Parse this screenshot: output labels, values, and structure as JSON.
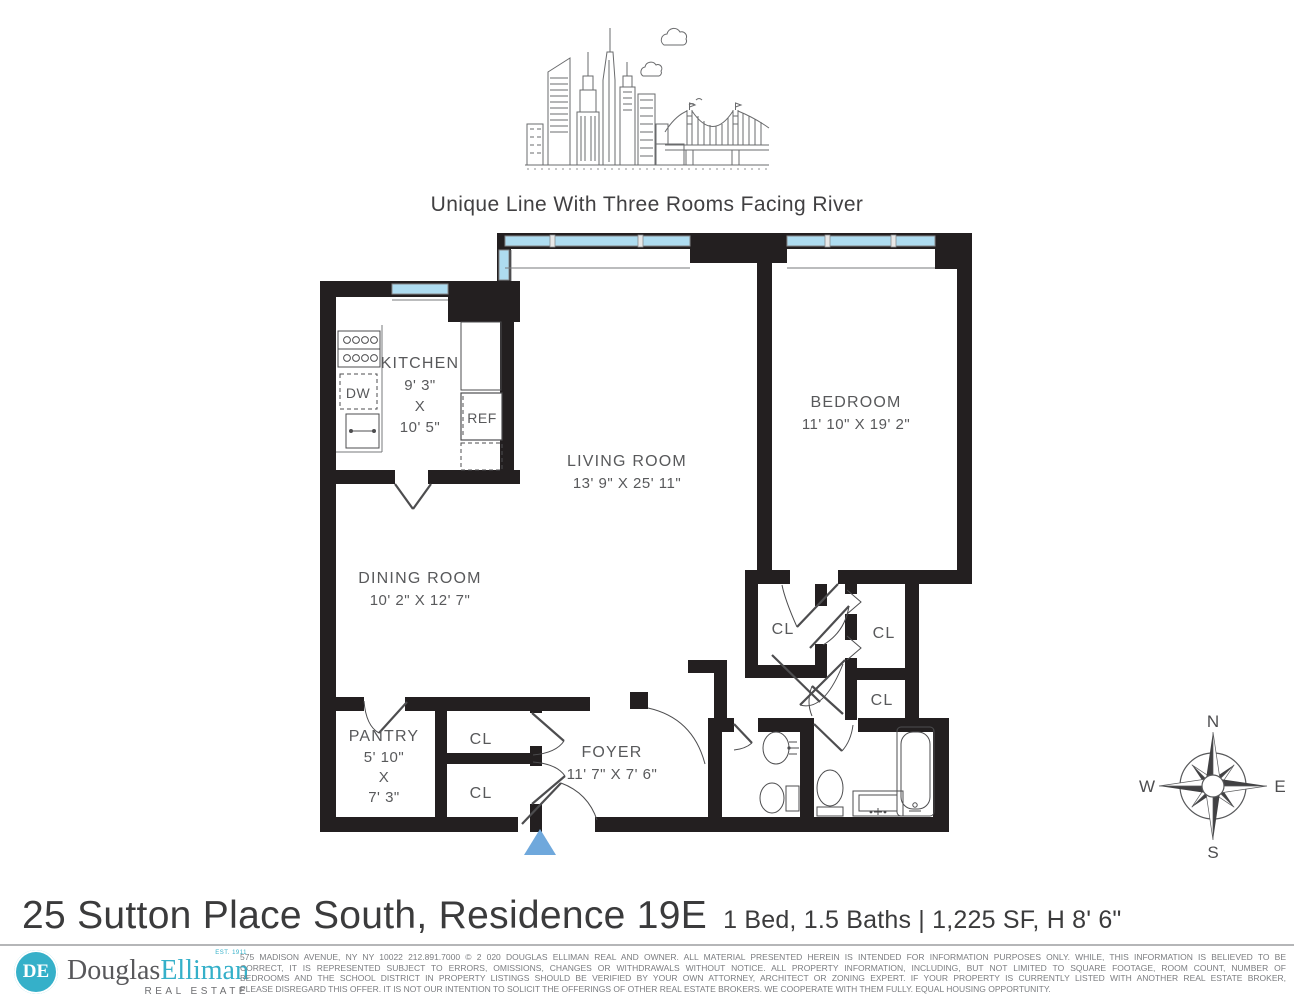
{
  "header": {
    "tagline": "Unique Line With Three Rooms Facing River"
  },
  "floorplan": {
    "rooms": {
      "kitchen": {
        "name": "KITCHEN",
        "dim1": "9' 3\"",
        "dim_x": "X",
        "dim2": "10' 5\""
      },
      "living": {
        "name": "LIVING ROOM",
        "dims": "13' 9\" X 25' 11\""
      },
      "bedroom": {
        "name": "BEDROOM",
        "dims": "11' 10\" X 19' 2\""
      },
      "dining": {
        "name": "DINING ROOM",
        "dims": "10' 2\" X 12' 7\""
      },
      "pantry": {
        "name": "PANTRY",
        "dim1": "5' 10\"",
        "dim_x": "X",
        "dim2": "7' 3\""
      },
      "foyer": {
        "name": "FOYER",
        "dims": "11' 7\" X 7' 6\""
      }
    },
    "fixtures": {
      "dishwasher": "DW",
      "refrigerator": "REF"
    },
    "closet_label": "CL",
    "compass": {
      "n": "N",
      "s": "S",
      "e": "E",
      "w": "W"
    }
  },
  "footer": {
    "address": "25 Sutton Place South, Residence 19E",
    "summary": "1 Bed, 1.5 Baths | 1,225 SF, H 8' 6\"",
    "brand": {
      "monogram": "DE",
      "name_part1": "Douglas",
      "name_part2": "Elliman",
      "est": "EST. 1911",
      "division": "REAL ESTATE"
    },
    "disclaimer_lines": [
      "575 MADISON AVENUE, NY NY 10022 212.891.7000 © 2 020 DOUGLAS ELLIMAN REAL AND OWNER. ALL MATERIAL PRESENTED HEREIN IS INTENDED FOR INFORMATION PURPOSES ONLY. WHILE, THIS INFORMATION IS BELIEVED TO BE",
      "CORRECT, IT IS REPRESENTED SUBJECT TO ERRORS, OMISSIONS, CHANGES OR WITHDRAWALS WITHOUT NOTICE. ALL PROPERTY INFORMATION, INCLUDING, BUT NOT LIMITED TO SQUARE FOOTAGE, ROOM COUNT, NUMBER OF",
      "BEDROOMS AND THE SCHOOL DISTRICT IN PROPERTY LISTINGS SHOULD BE VERIFIED BY YOUR OWN ATTORNEY, ARCHITECT OR ZONING EXPERT. IF YOUR PROPERTY IS CURRENTLY LISTED WITH ANOTHER REAL ESTATE BROKER,",
      "PLEASE DISREGARD THIS OFFER. IT IS NOT OUR INTENTION TO SOLICIT THE OFFERINGS OF OTHER REAL ESTATE BROKERS. WE COOPERATE WITH THEM FULLY. EQUAL HOUSING OPPORTUNITY."
    ]
  },
  "colors": {
    "wall": "#231f20",
    "window_glass": "#aedcf0",
    "entry_arrow": "#6fa8dc",
    "label_text": "#58595b",
    "brand_teal": "#35b0c9",
    "disclaimer_text": "#7b7d80"
  }
}
